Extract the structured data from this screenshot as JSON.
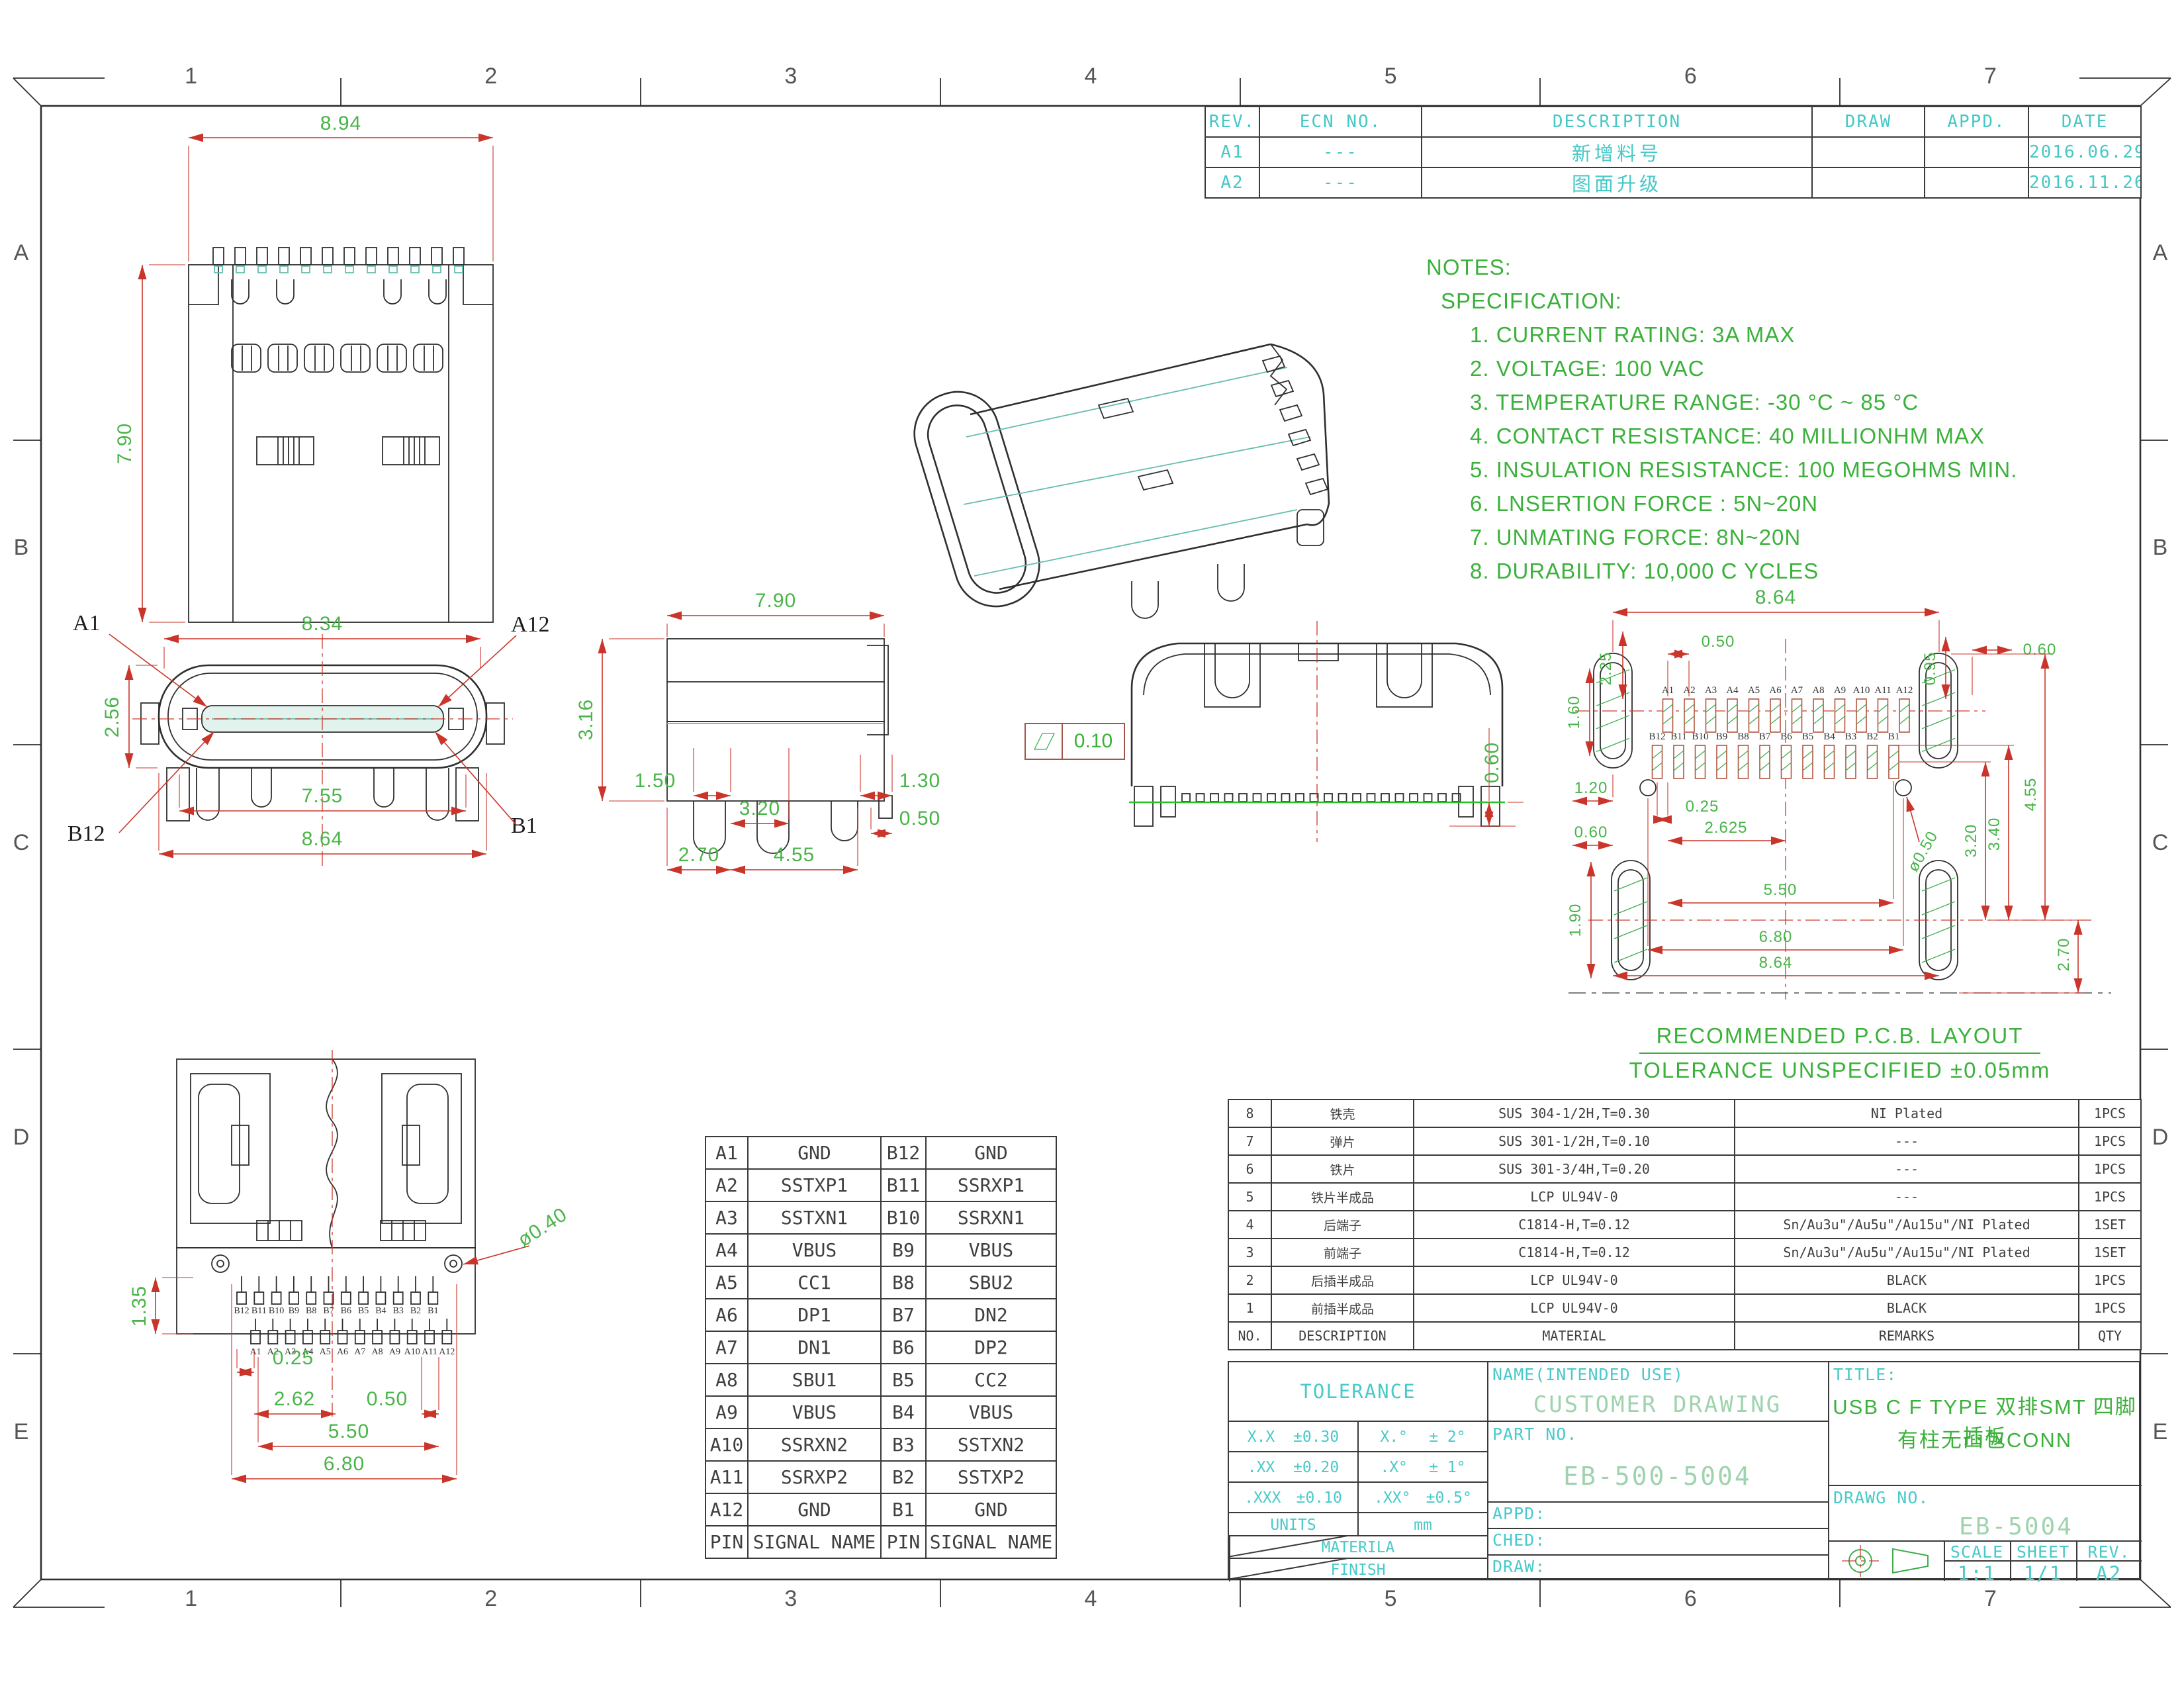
{
  "zones": {
    "cols": [
      "1",
      "2",
      "3",
      "4",
      "5",
      "6",
      "7"
    ],
    "rows": [
      "A",
      "B",
      "C",
      "D",
      "E"
    ]
  },
  "revision_table": {
    "headers": [
      "REV.",
      "ECN NO.",
      "DESCRIPTION",
      "DRAW",
      "APPD.",
      "DATE"
    ],
    "rows": [
      {
        "rev": "A1",
        "ecn": "---",
        "description": "新增料号",
        "draw": "",
        "appd": "",
        "date": "2016.06.29"
      },
      {
        "rev": "A2",
        "ecn": "---",
        "description": "图面升级",
        "draw": "",
        "appd": "",
        "date": "2016.11.26"
      }
    ]
  },
  "notes": {
    "title": "NOTES:",
    "subtitle": "SPECIFICATION:",
    "items": [
      "1. CURRENT RATING: 3A MAX",
      "2. VOLTAGE: 100 VAC",
      "3. TEMPERATURE RANGE: -30 °C ~ 85 °C",
      "4. CONTACT RESISTANCE: 40 MILLIONHM MAX",
      "5. INSULATION RESISTANCE: 100 MEGOHMS MIN.",
      "6. LNSERTION FORCE : 5N~20N",
      "7. UNMATING FORCE: 8N~20N",
      "8. DURABILITY:  10,000 C YCLES"
    ]
  },
  "views": {
    "top": {
      "dims": {
        "width": "8.94",
        "height": "7.90"
      }
    },
    "front": {
      "dims": {
        "w1": "8.34",
        "h": "2.56",
        "w2": "7.55",
        "w3": "8.64"
      },
      "labels": {
        "a1": "A1",
        "a12": "A12",
        "b12": "B12",
        "b1": "B1"
      }
    },
    "side": {
      "dims": {
        "w": "7.90",
        "h": "3.16",
        "d1": "1.50",
        "d2": "3.20",
        "d3": "1.30",
        "d4": "0.50",
        "d5": "2.70",
        "d6": "4.55"
      },
      "flatness": "0.10"
    },
    "rear": {
      "dims": {
        "h": "0.60"
      }
    },
    "bottom": {
      "dims": {
        "h": "1.35",
        "d1": "0.25",
        "d2": "2.62",
        "d3": "0.50",
        "d4": "5.50",
        "d5": "6.80",
        "dia": "ø0.40"
      }
    }
  },
  "pcb": {
    "caption1": "RECOMMENDED  P.C.B. LAYOUT",
    "caption2": "TOLERANCE UNSPECIFIED ±0.05mm",
    "pads_a": [
      "A1",
      "A2",
      "A3",
      "A4",
      "A5",
      "A6",
      "A7",
      "A8",
      "A9",
      "A10",
      "A11",
      "A12"
    ],
    "pads_b": [
      "B12",
      "B11",
      "B10",
      "B9",
      "B8",
      "B7",
      "B6",
      "B5",
      "B4",
      "B3",
      "B2",
      "B1"
    ],
    "dims": {
      "top_w": "8.64",
      "pitch": "0.50",
      "edge": "2.25",
      "r1": "0.95",
      "r2": "0.60",
      "left1": "1.60",
      "left2": "1.20",
      "c1": "0.25",
      "c2": "2.625",
      "left3": "0.60",
      "left4": "1.90",
      "mid": "5.50",
      "bot1": "6.80",
      "bot2": "8.64",
      "rt1": "3.20",
      "rt2": "3.40",
      "rt3": "4.55",
      "rb": "2.70",
      "dia": "ø0.50"
    }
  },
  "pin_table": {
    "headers": {
      "pin": "PIN",
      "signal": "SIGNAL NAME"
    },
    "rows": [
      {
        "pa": "A1",
        "sa": "GND",
        "pb": "B12",
        "sb": "GND"
      },
      {
        "pa": "A2",
        "sa": "SSTXP1",
        "pb": "B11",
        "sb": "SSRXP1"
      },
      {
        "pa": "A3",
        "sa": "SSTXN1",
        "pb": "B10",
        "sb": "SSRXN1"
      },
      {
        "pa": "A4",
        "sa": "VBUS",
        "pb": "B9",
        "sb": "VBUS"
      },
      {
        "pa": "A5",
        "sa": "CC1",
        "pb": "B8",
        "sb": "SBU2"
      },
      {
        "pa": "A6",
        "sa": "DP1",
        "pb": "B7",
        "sb": "DN2"
      },
      {
        "pa": "A7",
        "sa": "DN1",
        "pb": "B6",
        "sb": "DP2"
      },
      {
        "pa": "A8",
        "sa": "SBU1",
        "pb": "B5",
        "sb": "CC2"
      },
      {
        "pa": "A9",
        "sa": "VBUS",
        "pb": "B4",
        "sb": "VBUS"
      },
      {
        "pa": "A10",
        "sa": "SSRXN2",
        "pb": "B3",
        "sb": "SSTXN2"
      },
      {
        "pa": "A11",
        "sa": "SSRXP2",
        "pb": "B2",
        "sb": "SSTXP2"
      },
      {
        "pa": "A12",
        "sa": "GND",
        "pb": "B1",
        "sb": "GND"
      }
    ]
  },
  "bom_table": {
    "headers": {
      "no": "NO.",
      "description": "DESCRIPTION",
      "material": "MATERIAL",
      "remarks": "REMARKS",
      "qty": "QTY"
    },
    "rows": [
      {
        "no": "8",
        "description": "铁壳",
        "material": "SUS 304-1/2H,T=0.30",
        "remarks": "NI  Plated",
        "qty": "1PCS"
      },
      {
        "no": "7",
        "description": "弹片",
        "material": "SUS 301-1/2H,T=0.10",
        "remarks": "---",
        "qty": "1PCS"
      },
      {
        "no": "6",
        "description": "铁片",
        "material": "SUS 301-3/4H,T=0.20",
        "remarks": "---",
        "qty": "1PCS"
      },
      {
        "no": "5",
        "description": "铁片半成品",
        "material": "LCP UL94V-0",
        "remarks": "---",
        "qty": "1PCS"
      },
      {
        "no": "4",
        "description": "后端子",
        "material": "C1814-H,T=0.12",
        "remarks": "Sn/Au3u\"/Au5u\"/Au15u\"/NI Plated",
        "qty": "1SET"
      },
      {
        "no": "3",
        "description": "前端子",
        "material": "C1814-H,T=0.12",
        "remarks": "Sn/Au3u\"/Au5u\"/Au15u\"/NI Plated",
        "qty": "1SET"
      },
      {
        "no": "2",
        "description": "后插半成品",
        "material": "LCP UL94V-0",
        "remarks": "BLACK",
        "qty": "1PCS"
      },
      {
        "no": "1",
        "description": "前插半成品",
        "material": "LCP UL94V-0",
        "remarks": "BLACK",
        "qty": "1PCS"
      }
    ]
  },
  "title_block": {
    "tolerance_title": "TOLERANCE",
    "tol_rows": [
      {
        "l": "X.X",
        "lv": "±0.30",
        "r": "X.°",
        "rv": "± 2°"
      },
      {
        "l": ".XX",
        "lv": "±0.20",
        "r": ".X°",
        "rv": "± 1°"
      },
      {
        "l": ".XXX",
        "lv": "±0.10",
        "r": ".XX°",
        "rv": "±0.5°"
      }
    ],
    "units_label": "UNITS",
    "units_value": "mm",
    "material_label": "MATERILA",
    "finish_label": "FINISH",
    "name_label": "NAME(INTENDED USE)",
    "name_value": "CUSTOMER DRAWING",
    "part_no_label": "PART NO.",
    "part_no_value": "EB-500-5004",
    "appd_label": "APPD:",
    "ched_label": "CHED:",
    "draw_label": "DRAW:",
    "title_label": "TITLE:",
    "title_line1": "USB C F TYPE 双排SMT 四脚插板",
    "title_line2": "有柱无凸包CONN",
    "drawg_label": "DRAWG NO.",
    "drawg_value": "EB-5004",
    "scale_label": "SCALE",
    "scale_value": "1:1",
    "sheet_label": "SHEET",
    "sheet_value": "1/1",
    "rev_label": "REV.",
    "rev_value": "A2"
  },
  "colors": {
    "cyan": "#45c8c6",
    "green": "#3bb13b",
    "dim_green": "#49b449",
    "red": "#c9352a",
    "line": "#2f2f2f",
    "teal": "#66bdb0"
  }
}
